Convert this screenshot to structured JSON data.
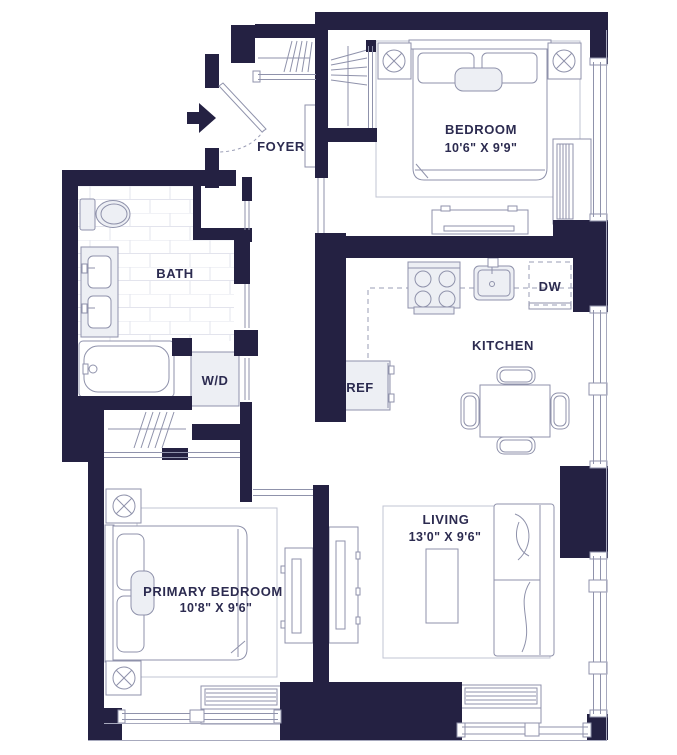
{
  "plan": {
    "rooms": {
      "foyer": {
        "name": "FOYER"
      },
      "bedroom": {
        "name": "BEDROOM",
        "dims": "10'6\" X 9'9\""
      },
      "bath": {
        "name": "BATH"
      },
      "kitchen": {
        "name": "KITCHEN"
      },
      "living": {
        "name": "LIVING",
        "dims": "13'0\" X 9'6\""
      },
      "primary_bedroom": {
        "name": "PRIMARY BEDROOM",
        "dims": "10'8\" X 9'6\""
      }
    },
    "appliances": {
      "washer_dryer": "W/D",
      "dishwasher": "DW",
      "refrigerator": "REF"
    },
    "colors": {
      "wall": "#242142",
      "furniture_line": "#8f92ab",
      "rug_line": "#c2c4d3",
      "tile_line": "#e3e4ed",
      "text": "#2c2b50",
      "appliance_fill": "#edeff4"
    }
  }
}
